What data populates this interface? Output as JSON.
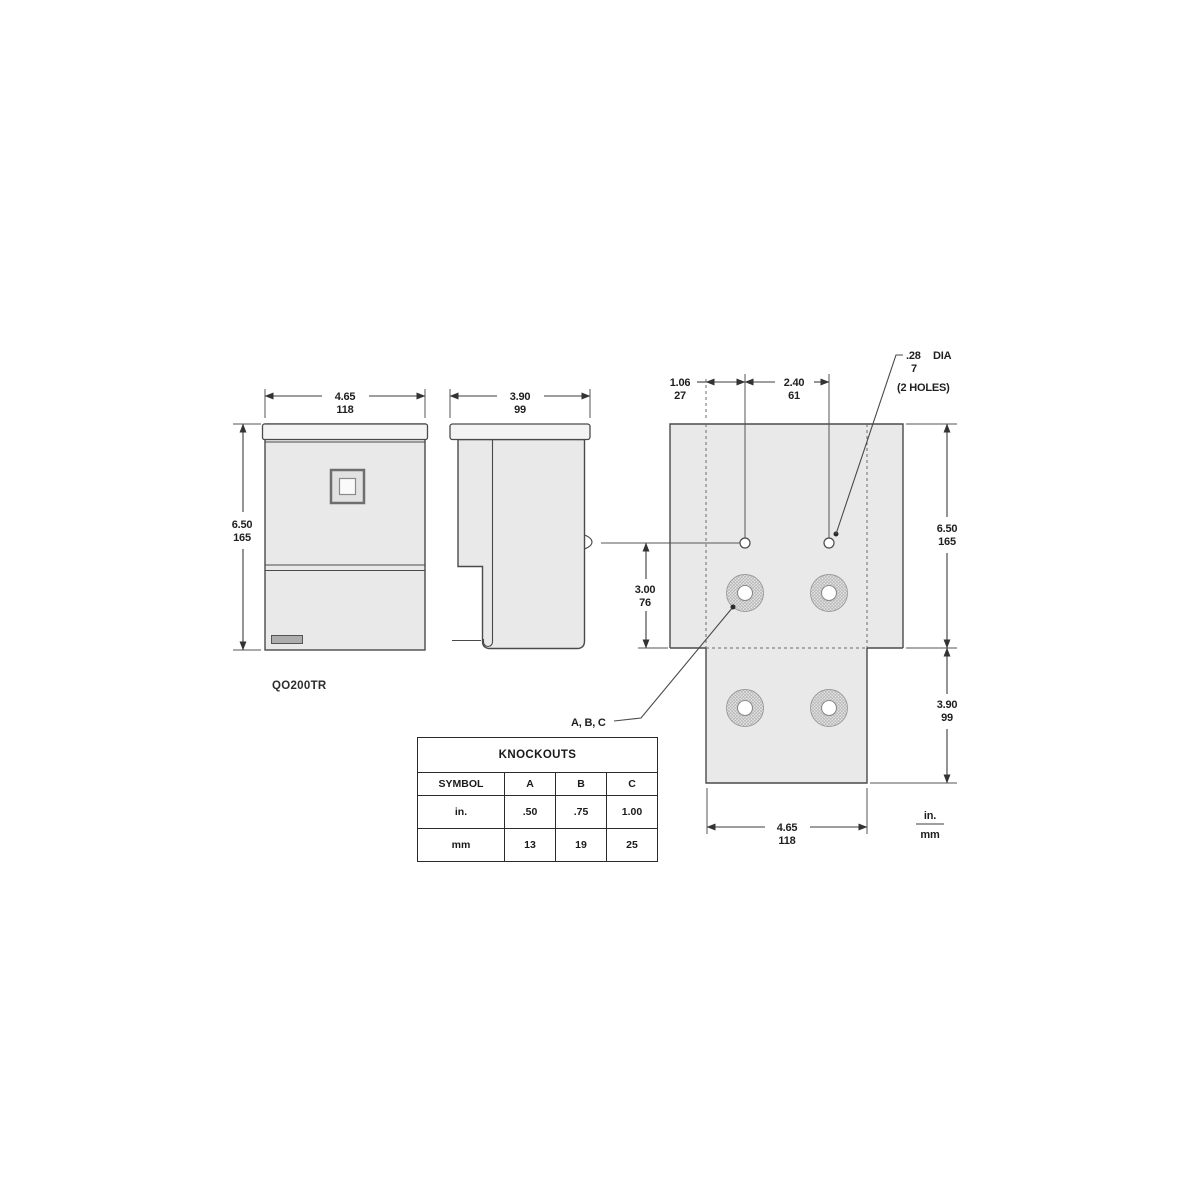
{
  "colors": {
    "line": "#4a4a4a",
    "panel_fill": "#e9e9e9",
    "cap_fill": "#f3f3f3",
    "background": "#ffffff",
    "hatch": "#b5b5b5"
  },
  "views": {
    "front": {
      "width_in": "4.65",
      "width_mm": "118",
      "height_in": "6.50",
      "height_mm": "165",
      "model": "QO200TR"
    },
    "side": {
      "depth_in": "3.90",
      "depth_mm": "99"
    },
    "back": {
      "hole_offset_in": "1.06",
      "hole_offset_mm": "27",
      "hole_spacing_in": "2.40",
      "hole_spacing_mm": "61",
      "hole_dia_in": ".28",
      "hole_dia_label": "DIA",
      "hole_dia_mm": "7",
      "hole_count_note": "(2 HOLES)",
      "hole_row_in": "3.00",
      "hole_row_mm": "76",
      "height_in": "6.50",
      "height_mm": "165",
      "flap_in": "3.90",
      "flap_mm": "99",
      "width_in": "4.65",
      "width_mm": "118",
      "knockout_callout": "A, B, C",
      "units_top": "in.",
      "units_bottom": "mm"
    }
  },
  "knockouts_table": {
    "title": "KNOCKOUTS",
    "columns": [
      "SYMBOL",
      "A",
      "B",
      "C"
    ],
    "rows": [
      {
        "symbol": "in.",
        "a": ".50",
        "b": ".75",
        "c": "1.00"
      },
      {
        "symbol": "mm",
        "a": "13",
        "b": "19",
        "c": "25"
      }
    ]
  }
}
